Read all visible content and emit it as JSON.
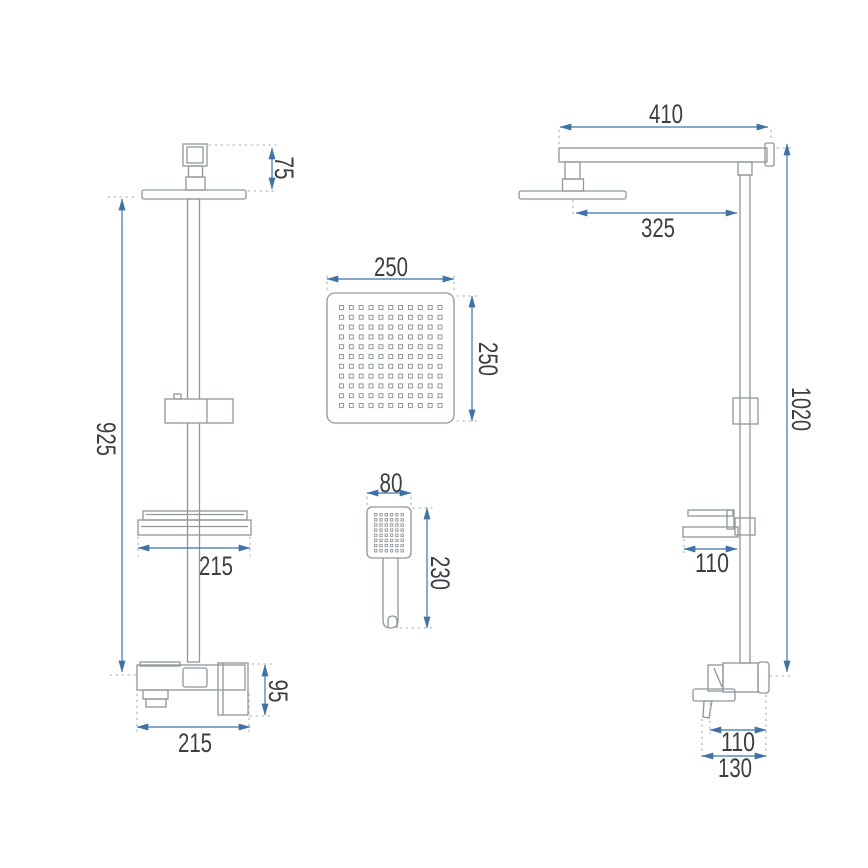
{
  "colors": {
    "background": "#ffffff",
    "outline": "#8f969c",
    "dimension": "#3f73a6",
    "dotted": "#aab0b5",
    "label": "#3b3e42"
  },
  "drawing": {
    "front_view": {
      "head_drop": "75",
      "rail_height": "925",
      "shelf_width": "215",
      "mixer_height": "95",
      "mixer_width": "215"
    },
    "rain_head": {
      "width": "250",
      "height": "250"
    },
    "hand_shower": {
      "width": "80",
      "height": "230"
    },
    "side_view": {
      "arm_length": "410",
      "head_reach": "325",
      "total_height": "1020",
      "shelf_depth": "110",
      "mixer_depth": "110",
      "mixer_total_depth": "130"
    }
  }
}
